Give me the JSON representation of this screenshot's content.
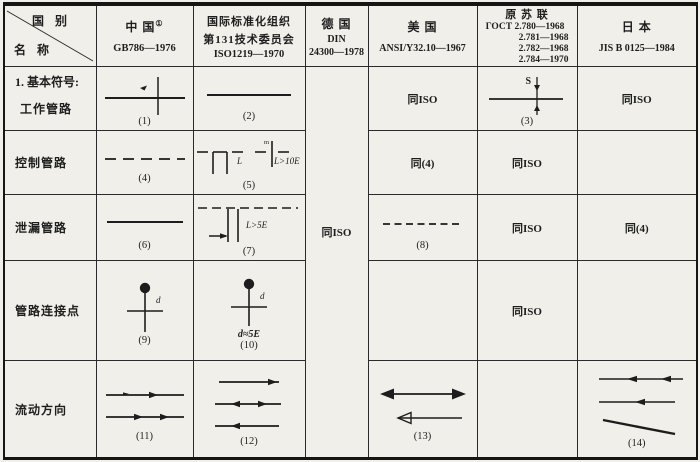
{
  "colors": {
    "paper": "#f0efe9",
    "ink": "#1d1d1d"
  },
  "header": {
    "corner": {
      "country": "国 别",
      "name": "名 称"
    },
    "china": {
      "title": "中 国",
      "sup": "①",
      "std": "GB786—1976"
    },
    "iso": {
      "line1": "国际标准化组织",
      "line2": "第131技术委员会",
      "line3": "ISO1219—1970"
    },
    "din": {
      "line1": "德 国",
      "line2": "DIN",
      "line3": "24300—1978"
    },
    "us": {
      "title": "美 国",
      "std": "ANSI/Y32.10—1967"
    },
    "ussr": {
      "title": "原 苏 联",
      "std1": "ГОСТ 2.780—1968",
      "std2": "2.781—1968",
      "std3": "2.782—1968",
      "std4": "2.784—1970"
    },
    "japan": {
      "title": "日 本",
      "std": "JIS B 0125—1984"
    }
  },
  "din_note": "同ISO",
  "rows": [
    {
      "section": "1. 基本符号:",
      "label": "工作管路",
      "china_num": "(1)",
      "iso_num": "(2)",
      "us_note": "同ISO",
      "ussr_label_s": "S",
      "ussr_num": "(3)",
      "japan_note": "同ISO"
    },
    {
      "label": "控制管路",
      "china_num": "(4)",
      "iso_label_l": "L",
      "iso_gap_label": "m",
      "iso_dim": "L>10E",
      "iso_num": "(5)",
      "us_note": "同(4)",
      "ussr_note": "同ISO"
    },
    {
      "label": "泄漏管路",
      "china_num": "(6)",
      "iso_dim": "L>5E",
      "iso_num": "(7)",
      "us_num": "(8)",
      "ussr_note": "同ISO",
      "japan_note": "同(4)"
    },
    {
      "label": "管路连接点",
      "china_label_d": "d",
      "china_num": "(9)",
      "iso_label_d": "d",
      "iso_dim": "d≈5E",
      "iso_num": "(10)",
      "ussr_note": "同ISO"
    },
    {
      "label": "流动方向",
      "china_num": "(11)",
      "iso_num": "(12)",
      "us_num": "(13)",
      "japan_num": "(14)"
    }
  ]
}
